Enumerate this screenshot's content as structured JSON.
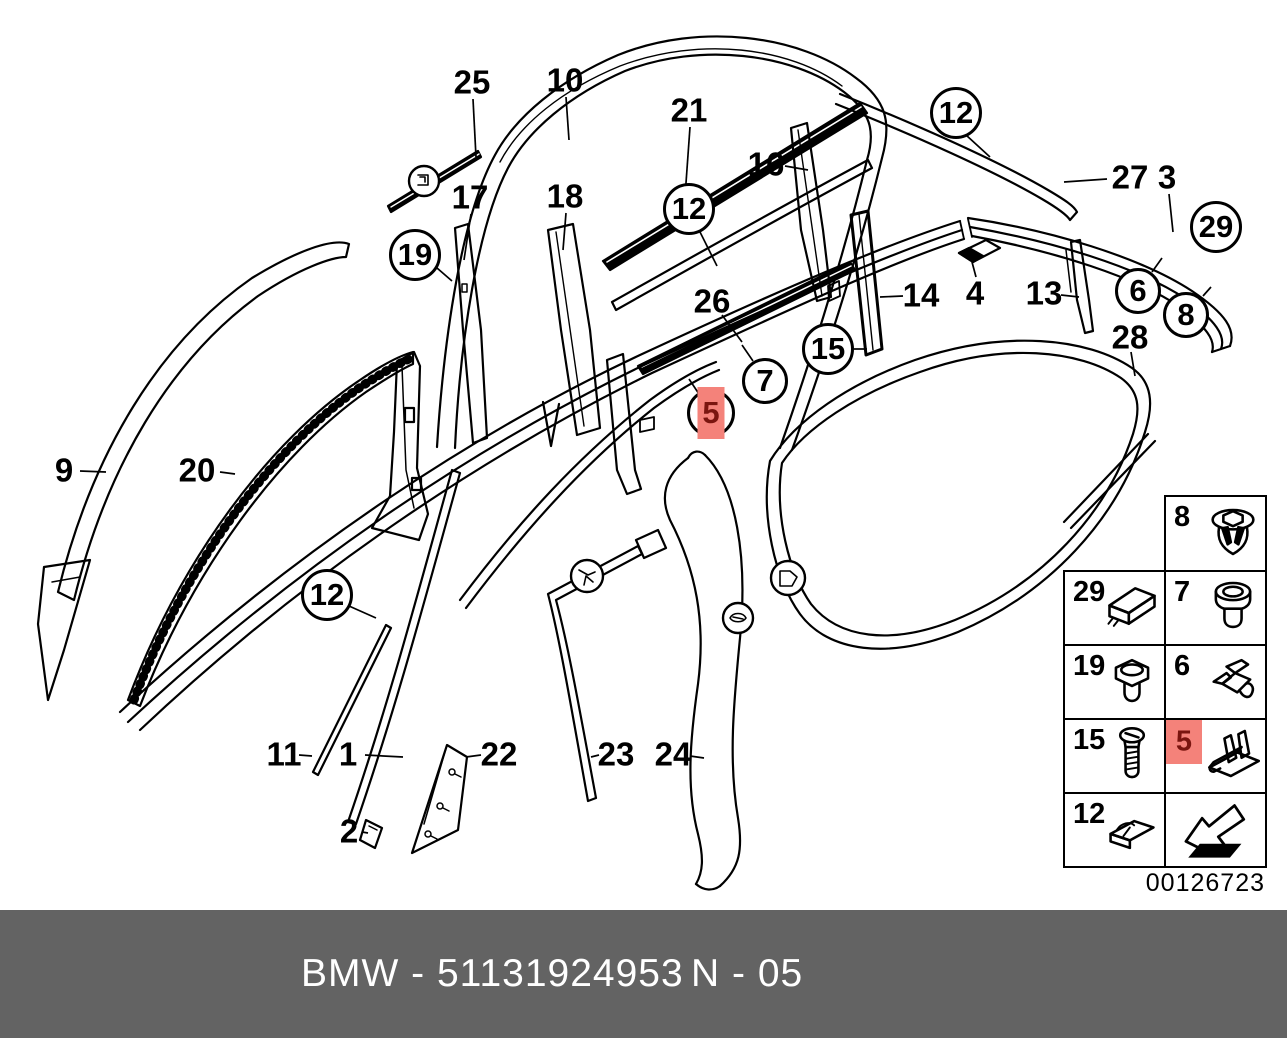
{
  "meta": {
    "type": "parts-diagram",
    "line_color": "#000000",
    "background": "#ffffff"
  },
  "diagram": {
    "code": "00126723",
    "highlight": {
      "box_color": "#f4827a",
      "number_color": "#7a150f"
    },
    "plain_labels": [
      {
        "text": "25",
        "x": 472,
        "y": 82,
        "leader": [
          473,
          99,
          476,
          157
        ]
      },
      {
        "text": "10",
        "x": 565,
        "y": 80,
        "leader": [
          566,
          97,
          569,
          140
        ]
      },
      {
        "text": "21",
        "x": 689,
        "y": 110,
        "leader": [
          690,
          127,
          683,
          225
        ]
      },
      {
        "text": "16",
        "x": 766,
        "y": 164,
        "leader": [
          785,
          166,
          808,
          170
        ]
      },
      {
        "text": "27",
        "x": 1130,
        "y": 177,
        "leader": [
          1107,
          179,
          1064,
          182
        ]
      },
      {
        "text": "3",
        "x": 1167,
        "y": 177,
        "leader": [
          1169,
          194,
          1173,
          232
        ]
      },
      {
        "text": "17",
        "x": 470,
        "y": 197,
        "leader": [
          471,
          214,
          464,
          260
        ]
      },
      {
        "text": "18",
        "x": 565,
        "y": 196,
        "leader": [
          566,
          213,
          563,
          250
        ]
      },
      {
        "text": "26",
        "x": 712,
        "y": 301,
        "leader": [
          722,
          315,
          742,
          342
        ]
      },
      {
        "text": "14",
        "x": 921,
        "y": 295,
        "leader": [
          903,
          296,
          880,
          297
        ]
      },
      {
        "text": "4",
        "x": 975,
        "y": 293,
        "leader": [
          976,
          277,
          972,
          262
        ]
      },
      {
        "text": "13",
        "x": 1044,
        "y": 293,
        "leader": [
          1061,
          295,
          1079,
          297
        ]
      },
      {
        "text": "28",
        "x": 1130,
        "y": 337,
        "leader": [
          1131,
          352,
          1135,
          376
        ]
      },
      {
        "text": "9",
        "x": 64,
        "y": 470,
        "leader": [
          80,
          471,
          106,
          472
        ]
      },
      {
        "text": "20",
        "x": 197,
        "y": 470,
        "leader": [
          220,
          472,
          235,
          474
        ]
      },
      {
        "text": "11",
        "x": 284,
        "y": 754,
        "leader": [
          299,
          755,
          312,
          756
        ]
      },
      {
        "text": "1",
        "x": 348,
        "y": 754,
        "leader": [
          365,
          755,
          403,
          757
        ]
      },
      {
        "text": "22",
        "x": 499,
        "y": 754,
        "leader": [
          481,
          755,
          466,
          757
        ]
      },
      {
        "text": "23",
        "x": 616,
        "y": 754,
        "leader": [
          599,
          755,
          591,
          757
        ]
      },
      {
        "text": "24",
        "x": 673,
        "y": 754,
        "leader": [
          690,
          756,
          704,
          758
        ]
      },
      {
        "text": "2",
        "x": 349,
        "y": 831,
        "leader": [
          362,
          832,
          368,
          833
        ]
      }
    ],
    "circled_labels": [
      {
        "text": "12",
        "cx": 956,
        "cy": 113,
        "r": 26,
        "highlighted": false,
        "leader": [
          966,
          135,
          990,
          157
        ]
      },
      {
        "text": "29",
        "cx": 1216,
        "cy": 227,
        "r": 26,
        "highlighted": false,
        "leader": null
      },
      {
        "text": "19",
        "cx": 415,
        "cy": 255,
        "r": 26,
        "highlighted": false,
        "leader": [
          437,
          268,
          452,
          281
        ]
      },
      {
        "text": "12",
        "cx": 689,
        "cy": 209,
        "r": 26,
        "highlighted": false,
        "leader": [
          700,
          232,
          717,
          266
        ]
      },
      {
        "text": "6",
        "cx": 1138,
        "cy": 291,
        "r": 23,
        "highlighted": false,
        "leader": [
          1152,
          272,
          1162,
          258
        ]
      },
      {
        "text": "8",
        "cx": 1186,
        "cy": 315,
        "r": 23,
        "highlighted": false,
        "leader": [
          1203,
          296,
          1211,
          287
        ]
      },
      {
        "text": "15",
        "cx": 828,
        "cy": 349,
        "r": 26,
        "highlighted": false,
        "leader": [
          854,
          349,
          867,
          349
        ]
      },
      {
        "text": "7",
        "cx": 765,
        "cy": 381,
        "r": 23,
        "highlighted": false,
        "leader": [
          753,
          361,
          742,
          345
        ]
      },
      {
        "text": "5",
        "cx": 711,
        "cy": 413,
        "r": 24,
        "highlighted": true,
        "leader": [
          699,
          394,
          689,
          379
        ]
      },
      {
        "text": "12",
        "cx": 327,
        "cy": 595,
        "r": 26,
        "highlighted": false,
        "leader": [
          349,
          606,
          376,
          618
        ]
      }
    ]
  },
  "legend": {
    "cells": [
      {
        "row": 0,
        "col": 1,
        "label": "8",
        "icon": "expanding-rivet",
        "highlighted": false
      },
      {
        "row": 1,
        "col": 0,
        "label": "29",
        "icon": "clamp-block",
        "highlighted": false
      },
      {
        "row": 1,
        "col": 1,
        "label": "7",
        "icon": "grommet",
        "highlighted": false
      },
      {
        "row": 2,
        "col": 0,
        "label": "19",
        "icon": "hex-plug",
        "highlighted": false
      },
      {
        "row": 2,
        "col": 1,
        "label": "6",
        "icon": "spring-clip",
        "highlighted": false
      },
      {
        "row": 3,
        "col": 0,
        "label": "15",
        "icon": "screw",
        "highlighted": false
      },
      {
        "row": 3,
        "col": 1,
        "label": "5",
        "icon": "wedge-cover",
        "highlighted": true
      },
      {
        "row": 4,
        "col": 0,
        "label": "12",
        "icon": "retainer-clip",
        "highlighted": false
      },
      {
        "row": 4,
        "col": 1,
        "label": "",
        "icon": "direction-arrow",
        "highlighted": false
      }
    ]
  },
  "footer": {
    "left_text": "BMW - 51131924953",
    "right_text": "N - 05",
    "bg_color": "#636363",
    "text_color": "#ffffff"
  }
}
